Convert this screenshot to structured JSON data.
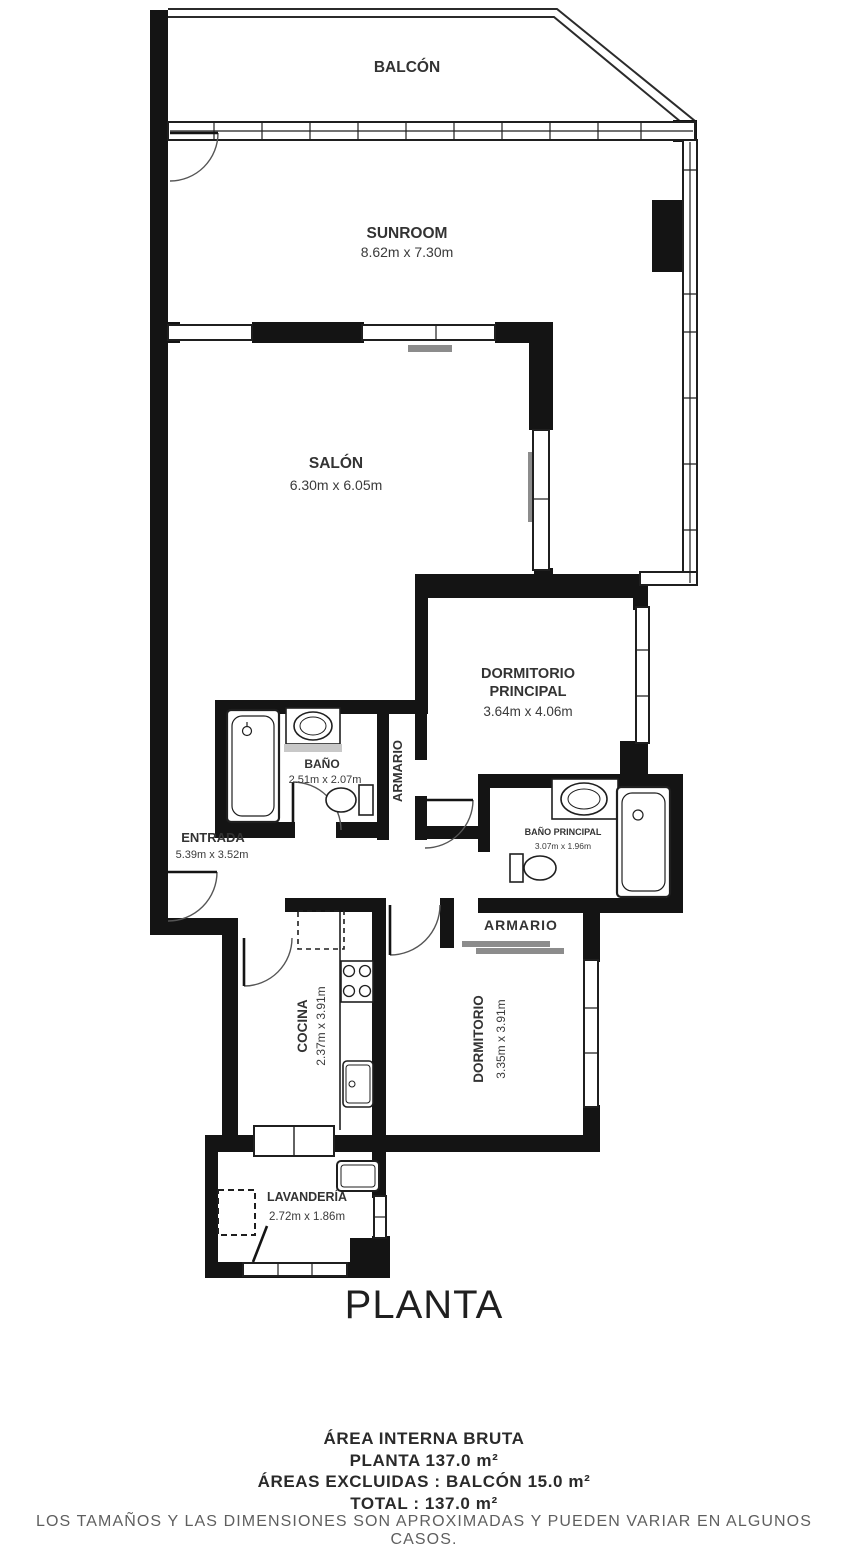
{
  "plan": {
    "title": "PLANTA",
    "rooms": {
      "balcon": {
        "name": "BALCÓN"
      },
      "sunroom": {
        "name": "SUNROOM",
        "dims": "8.62m x 7.30m"
      },
      "salon": {
        "name": "SALÓN",
        "dims": "6.30m x 6.05m"
      },
      "dormitorio_principal": {
        "name_line1": "DORMITORIO",
        "name_line2": "PRINCIPAL",
        "dims": "3.64m x 4.06m"
      },
      "bano": {
        "name": "BAÑO",
        "dims": "2.51m x 2.07m"
      },
      "armario_pasillo": {
        "name": "ARMARIO"
      },
      "entrada": {
        "name": "ENTRADA",
        "dims": "5.39m x 3.52m"
      },
      "bano_principal": {
        "name": "BAÑO PRINCIPAL",
        "dims": "3.07m x 1.96m"
      },
      "armario_dormitorio": {
        "name": "ARMARIO"
      },
      "cocina": {
        "name": "COCINA",
        "dims": "2.37m x 3.91m"
      },
      "dormitorio": {
        "name": "DORMITORIO",
        "dims": "3.35m x 3.91m"
      },
      "lavanderia": {
        "name": "LAVANDERÍA",
        "dims": "2.72m x 1.86m"
      }
    },
    "colors": {
      "wall": "#141414",
      "line": "#1f1f1f",
      "gray": "#9e9e9e"
    }
  },
  "footer": {
    "line1": "ÁREA INTERNA BRUTA",
    "line2": "PLANTA 137.0 m²",
    "line3": "ÁREAS EXCLUIDAS :  BALCÓN 15.0 m²",
    "line4": "TOTAL :  137.0 m²",
    "disclaimer": "LOS TAMAÑOS Y LAS DIMENSIONES SON APROXIMADAS Y PUEDEN VARIAR EN ALGUNOS CASOS."
  }
}
